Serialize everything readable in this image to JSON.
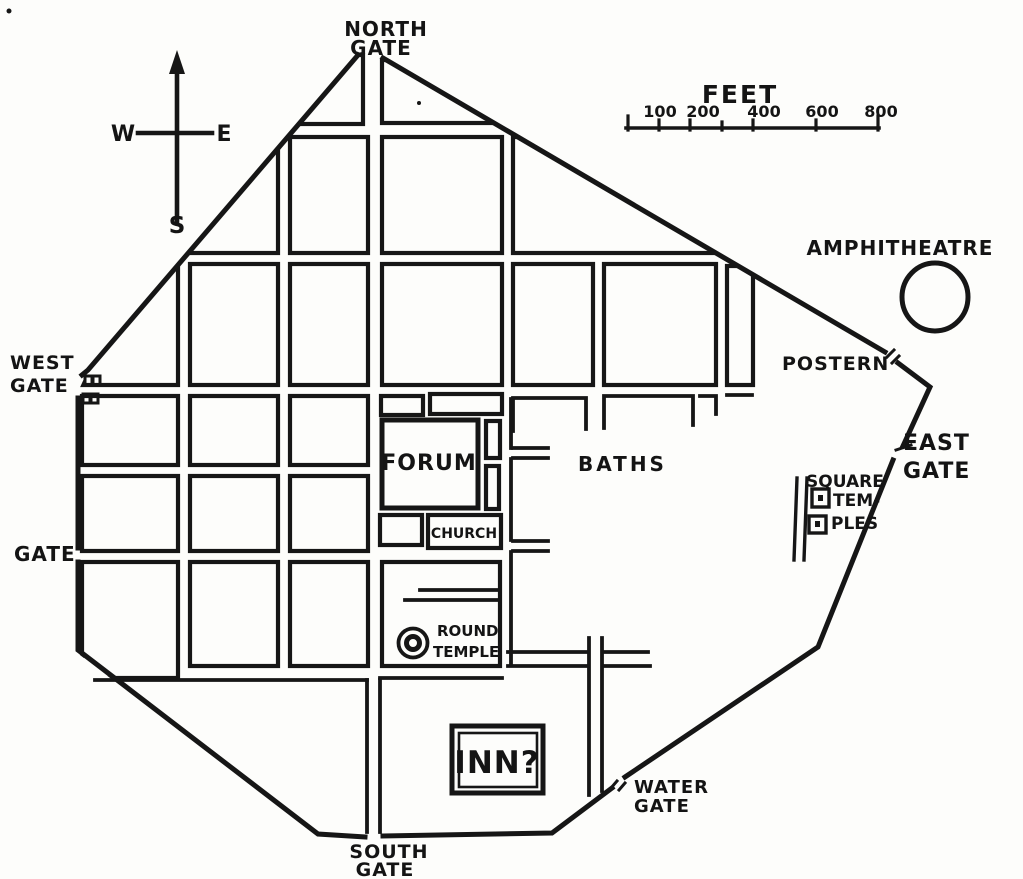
{
  "map": {
    "kind": "roman-town-plan",
    "colors": {
      "ink": "#161616",
      "paper": "#fdfdfb"
    },
    "labels": {
      "north_gate_line1": "NORTH",
      "north_gate_line2": "GATE",
      "west_gate_line1": "WEST",
      "west_gate_line2": "GATE",
      "west_gate_south": "GATE",
      "south_gate_line1": "SOUTH",
      "south_gate_line2": "GATE",
      "water_gate_line1": "WATER",
      "water_gate_line2": "GATE",
      "east_gate_line1": "EAST",
      "east_gate_line2": "GATE",
      "postern": "POSTERN",
      "amphitheatre": "AMPHITHEATRE",
      "baths": "BATHS",
      "forum": "FORUM",
      "church": "CHURCH",
      "inn": "INN?",
      "round_temple_line1": "ROUND",
      "round_temple_line2": "TEMPLE",
      "square_temples_line1": "SQUARE",
      "square_temples_line2": "TEM-",
      "square_temples_line3": "PLES"
    },
    "compass": {
      "west": "W",
      "east": "E",
      "south": "S"
    },
    "scale_bar": {
      "title": "FEET",
      "tick_labels": [
        "100",
        "200",
        "400",
        "600",
        "800"
      ]
    }
  }
}
